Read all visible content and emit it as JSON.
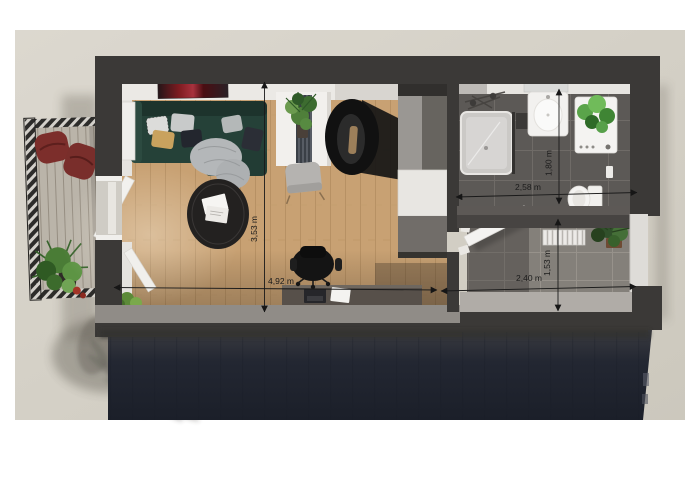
{
  "dimensions": {
    "living_width": "4,92 m",
    "living_depth": "3,53 m",
    "bathroom_width": "2,58 m",
    "bathroom_depth": "1,80 m",
    "hallway_width": "2,40 m",
    "hallway_depth": "1,53 m"
  },
  "palette": {
    "page_background": "#ffffff",
    "canvas_background": "#d5d1c7",
    "outer_wall": "#3b3937",
    "building_facade": "#20242e",
    "wood_floor": "#c8a173",
    "bathroom_floor": "#5c5956",
    "hallway_floor": "#84807a",
    "interior_wall": "#eae8e4",
    "sofa": "#254138",
    "pouf_red": "#7c2e2b",
    "plant_green": "#4e7d3c",
    "dimension_ink": "#1a1a1a"
  }
}
